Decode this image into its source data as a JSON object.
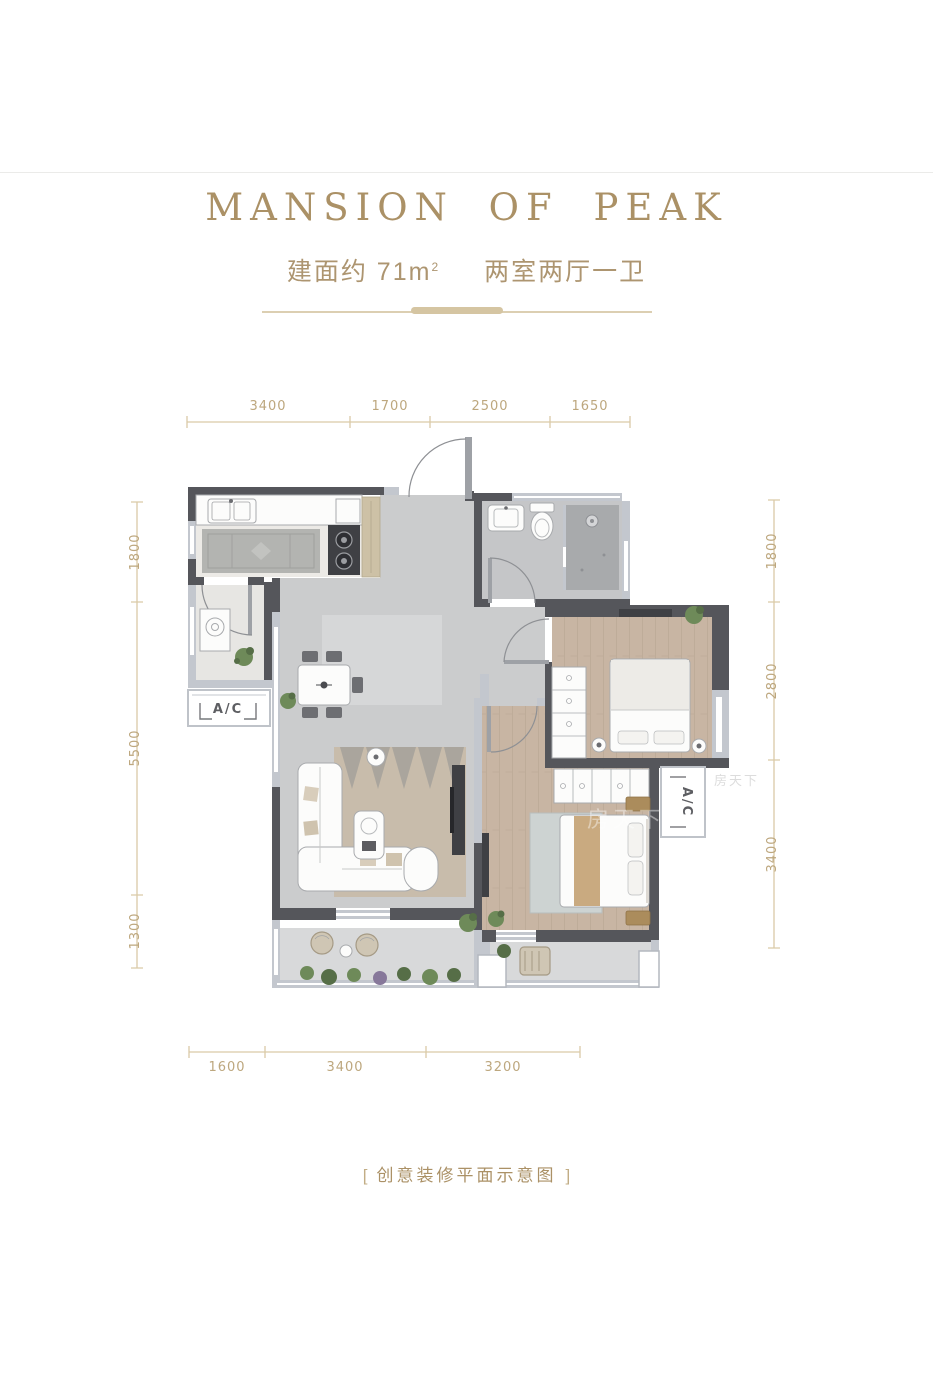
{
  "header": {
    "title": "MANSION OF PEAK",
    "area_prefix": "建面约 71m",
    "area_sup": "2",
    "rooms_label": "两室两厅一卫"
  },
  "dimensions": {
    "top": [
      "3400",
      "1700",
      "2500",
      "1650"
    ],
    "bottom": [
      "1600",
      "3400",
      "3200"
    ],
    "left": [
      "1800",
      "5500",
      "1300"
    ],
    "right": [
      "1800",
      "2800",
      "3400"
    ]
  },
  "plan": {
    "ac_left": "A/C",
    "ac_right": "A/C",
    "watermark": "房天下"
  },
  "caption": {
    "bracket_open": "[",
    "text": "创意装修平面示意图",
    "bracket_close": "]"
  },
  "colors": {
    "gold_title": "#ab9166",
    "gold_dim_text": "#bda77e",
    "dim_line": "#dacaa7",
    "wall_dark": "#55565b",
    "wall_light": "#c3c7ce",
    "wood_floor": "#c8b5a3",
    "tile_floor": "#cbcccd",
    "cabinet_tan": "#cdc1a6"
  }
}
